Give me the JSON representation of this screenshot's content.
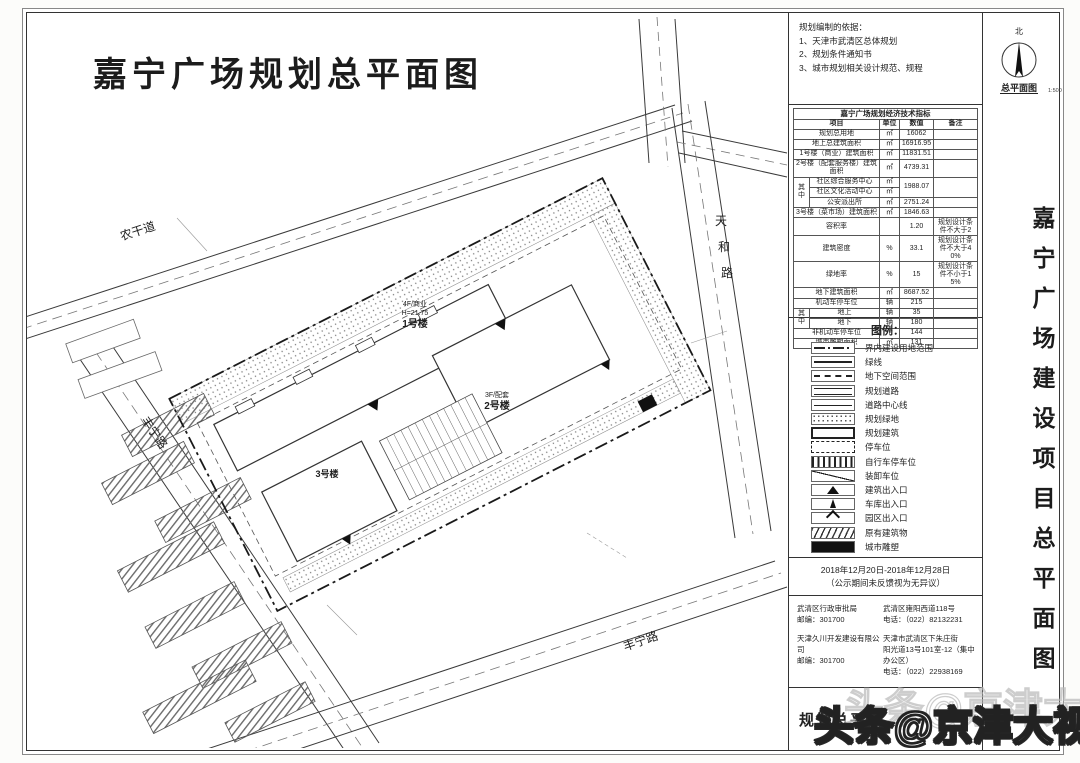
{
  "sheet": {
    "title": "嘉宁广场规划总平面图",
    "side_title": "嘉宁广场建设项目总平面图",
    "title_block_label": "规划总平面",
    "compass": {
      "north": "北",
      "caption": "总平面图",
      "scale": "1:500"
    }
  },
  "notes": {
    "heading": "规划编制的依据：",
    "items": [
      "1、天津市武清区总体规划",
      "2、规划条件通知书",
      "3、城市规划相关设计规范、规程"
    ]
  },
  "table": {
    "title": "嘉宁广场规划经济技术指标",
    "headers": [
      {
        "t": "项目",
        "cs": 2
      },
      {
        "t": "单位"
      },
      {
        "t": "数值"
      },
      {
        "t": "备注"
      }
    ],
    "rows": [
      [
        {
          "t": "规划总用地",
          "cs": 2
        },
        {
          "t": "㎡"
        },
        {
          "t": "16062"
        },
        {
          "t": ""
        }
      ],
      [
        {
          "t": "地上总建筑面积",
          "cs": 2
        },
        {
          "t": "㎡"
        },
        {
          "t": "16916.95"
        },
        {
          "t": ""
        }
      ],
      [
        {
          "t": "1号楼（商业）建筑面积",
          "cs": 2
        },
        {
          "t": "㎡"
        },
        {
          "t": "11831.51"
        },
        {
          "t": ""
        }
      ],
      [
        {
          "t": "2号楼（配套服务楼）建筑面积",
          "cs": 2
        },
        {
          "t": "㎡"
        },
        {
          "t": "4739.31"
        },
        {
          "t": ""
        }
      ],
      [
        {
          "t": "其中",
          "rs": 3
        },
        {
          "t": "社区综合服务中心"
        },
        {
          "t": "㎡"
        },
        {
          "t": "1988.07",
          "rs": 2
        },
        {
          "t": "",
          "rs": 2
        }
      ],
      [
        {
          "t": "社区文化活动中心"
        },
        {
          "t": "㎡"
        }
      ],
      [
        {
          "t": "公安派出所"
        },
        {
          "t": "㎡"
        },
        {
          "t": "2751.24"
        },
        {
          "t": ""
        }
      ],
      [
        {
          "t": "3号楼（菜市场）建筑面积",
          "cs": 2
        },
        {
          "t": "㎡"
        },
        {
          "t": "1846.63"
        },
        {
          "t": ""
        }
      ],
      [
        {
          "t": "容积率",
          "cs": 2
        },
        {
          "t": ""
        },
        {
          "t": "1.20"
        },
        {
          "t": "规划设计条件不大于2"
        }
      ],
      [
        {
          "t": "建筑密度",
          "cs": 2
        },
        {
          "t": "%"
        },
        {
          "t": "33.1"
        },
        {
          "t": "规划设计条件不大于40%"
        }
      ],
      [
        {
          "t": "绿地率",
          "cs": 2
        },
        {
          "t": "%"
        },
        {
          "t": "15"
        },
        {
          "t": "规划设计条件不小于15%"
        }
      ],
      [
        {
          "t": "地下建筑面积",
          "cs": 2
        },
        {
          "t": "㎡"
        },
        {
          "t": "8687.52"
        },
        {
          "t": ""
        }
      ],
      [
        {
          "t": "机动车停车位",
          "cs": 2
        },
        {
          "t": "辆"
        },
        {
          "t": "215"
        },
        {
          "t": ""
        }
      ],
      [
        {
          "t": "其中",
          "rs": 2
        },
        {
          "t": "地上"
        },
        {
          "t": "辆"
        },
        {
          "t": "35"
        },
        {
          "t": ""
        }
      ],
      [
        {
          "t": "地下"
        },
        {
          "t": "辆"
        },
        {
          "t": "180"
        },
        {
          "t": ""
        }
      ],
      [
        {
          "t": "非机动车停车位",
          "cs": 2
        },
        {
          "t": "个"
        },
        {
          "t": "144"
        },
        {
          "t": ""
        }
      ],
      [
        {
          "t": "城市雕塑面积",
          "cs": 2
        },
        {
          "t": "㎡"
        },
        {
          "t": "131"
        },
        {
          "t": ""
        }
      ]
    ]
  },
  "legend": {
    "title": "图例：",
    "items": [
      {
        "symbol": "dashdot-line",
        "label": "界内建设用地范围"
      },
      {
        "symbol": "solid-line",
        "label": "绿线"
      },
      {
        "symbol": "dashed-line",
        "label": "地下空间范围"
      },
      {
        "symbol": "double-line",
        "label": "规划道路"
      },
      {
        "symbol": "center-line",
        "label": "道路中心线"
      },
      {
        "symbol": "dot-fill",
        "label": "规划绿地"
      },
      {
        "symbol": "bold-outline",
        "label": "规划建筑"
      },
      {
        "symbol": "dashed-box",
        "label": "停车位"
      },
      {
        "symbol": "vert-hatch",
        "label": "自行车停车位"
      },
      {
        "symbol": "diag-line",
        "label": "装卸车位"
      },
      {
        "symbol": "tri-filled",
        "label": "建筑出入口"
      },
      {
        "symbol": "tri-narrow",
        "label": "车库出入口"
      },
      {
        "symbol": "chevron",
        "label": "园区出入口"
      },
      {
        "symbol": "diag-hatch",
        "label": "原有建筑物"
      },
      {
        "symbol": "solid-fill",
        "label": "城市雕塑"
      }
    ]
  },
  "publicity": {
    "dates": "2018年12月20日-2018年12月28日",
    "note": "（公示期间未反馈视为无异议）"
  },
  "contacts": [
    {
      "left": [
        "武清区行政审批局",
        "邮编：301700"
      ],
      "right": [
        "武清区雍阳西道118号",
        "电话：（022）82132231"
      ]
    },
    {
      "left": [
        "天津久川开发建设有限公司",
        "邮编：301700"
      ],
      "right": [
        "天津市武清区下朱庄街",
        "阳光道13号101室-12（集中办公区）",
        "电话：（022）22938169"
      ]
    }
  ],
  "drawing": {
    "roads": {
      "nonggandao": "农干道",
      "tianhelu_chars": [
        "天",
        "和",
        "路"
      ],
      "fengninglu_west": "丰宁路",
      "fengninglu_south": "丰宁路"
    },
    "buildings": {
      "b1": {
        "lines": [
          "4F/商业",
          "H=21.75",
          "1号楼"
        ]
      },
      "b2": {
        "lines": [
          "3F/配套",
          "2号楼"
        ]
      },
      "b3": {
        "lines": [
          "3号楼"
        ]
      }
    }
  },
  "watermark": "头条@京津大视野"
}
